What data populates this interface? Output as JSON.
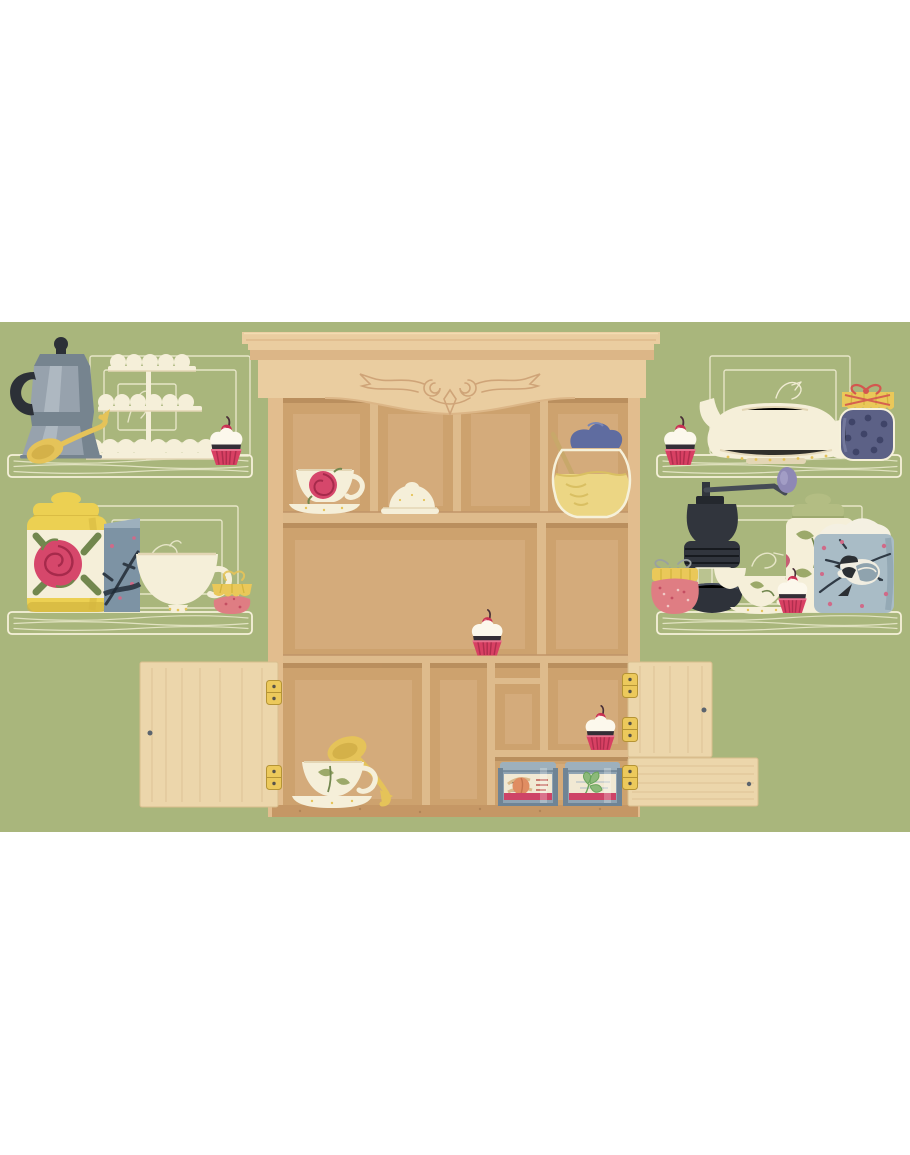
{
  "scene": {
    "title": "Tea cupboard wall illustration",
    "background_color": "#a9b67c",
    "page_background": "#ffffff"
  },
  "palette": {
    "bg_green": "#a9b67c",
    "sketch_cream": "#f6f1da",
    "wood_frame": "#e2bd8e",
    "wood_crown": "#eacda0",
    "wood_crown_shade": "#dcb687",
    "wood_carve": "#cfa478",
    "wood_interior": "#cda26e",
    "wood_interior_light": "#d9b184",
    "wood_divider": "#debb8c",
    "wood_floor": "#c59765",
    "wood_door": "#ecd6ab",
    "wood_door_grain": "#d9bd8f",
    "hinge_gold": "#ecc95b",
    "hinge_dark": "#b59435",
    "knob_grey": "#5b646e",
    "cream": "#f5efd9",
    "cream_shade": "#e3d6b5",
    "gold": "#e5c359",
    "gold_dark": "#c7a23c",
    "pink_wrap": "#d84063",
    "pink_wrap_dark": "#b02e4e",
    "frosting": "#fcf8ec",
    "chocolate": "#342e36",
    "cherry": "#c93052",
    "rose": "#d6476b",
    "rose_dark": "#a62a4b",
    "leaf": "#9ca96a",
    "leaf_dark": "#72874e",
    "ink_black": "#2c3037",
    "moka": "#97a2ad",
    "moka_light": "#aeb8c1",
    "moka_dark": "#76848f",
    "yellow_can": "#ecd052",
    "yellow_can_dark": "#d3b53e",
    "tin_blue": "#7d93a4",
    "tin_blue_light": "#9db0bd",
    "tin_steel": "#8fa3b2",
    "tin_steel_dark": "#6f8495",
    "branch": "#2f3a45",
    "blossom": "#d06a88",
    "jam_red": "#df7d83",
    "jam_red_dark": "#c44e62",
    "lid_yellow": "#eac859",
    "ribbon": "#d4574f",
    "twine": "#9aa0a0",
    "blueberry": "#5c6186",
    "blueberry_dark": "#3f4468",
    "honey": "#ecd684",
    "honey_dark": "#d9bf62",
    "honey_lid": "#5f6ca0",
    "dipper": "#c8a86a",
    "grinder": "#31353d",
    "grinder_dark": "#24282e",
    "knob_purple": "#8e88b5",
    "can_green": "#b3bd83",
    "chick_blue": "#a9bcc6",
    "sugar": "#f4f0e2",
    "bird_black": "#2b2f33",
    "bird_white": "#f0ede1",
    "wing": "#8fa3ae",
    "label_cream": "#f1e9d3",
    "band_pink": "#ce4467",
    "peach": "#e08d62",
    "peach_leaf": "#d9b98a",
    "mint": "#8cb97a",
    "mint_dark": "#69a45b",
    "red_text": "#c05a52",
    "shadow_brown": "#8e643c"
  },
  "items": {
    "cabinet": "Carved wooden wall cabinet",
    "left_shelf_top": "Left upper wall shelf",
    "left_shelf_bottom": "Left lower wall shelf",
    "right_shelf_top": "Right upper wall shelf",
    "right_shelf_bottom": "Right lower wall shelf",
    "moka_pot": "Grey moka espresso pot",
    "gold_spoon": "Gold serving spoon",
    "cake_stand": "Three-tier scalloped dessert stand",
    "cupcake": "Cherry cupcake in pink wrapper",
    "rose_canister": "Yellow canister with rose motif",
    "blossom_tin": "Blue tea tin with blossom branch",
    "white_teacup": "Large cream teacup",
    "cloth_jam_jar": "Red jam jar with yellow cloth lid",
    "teapot": "Cream teapot with bird sketch",
    "blueberry_jar": "Blueberry jam jar with ribbon bow",
    "strawberry_jar": "Strawberry jam jar with twine bow",
    "coffee_grinder": "Black manual coffee grinder",
    "cup_stack": "Cream cups with leaf teacup",
    "leaf_canister": "Leaf-pattern canister with green lid",
    "chickadee_canister": "Blue sugar canister with chickadee",
    "rose_teacup": "Rose teacup on saucer",
    "butter_dish": "Cream butter dish",
    "honey_pot": "Honey pot with wooden dipper",
    "leaf_teacup": "Leaf teacup on saucer",
    "tea_tin_peach": "Peach tea tin",
    "tea_tin_mint": "Mint tea tin",
    "door_left": "Open cabinet door, left",
    "door_right_upper": "Open cabinet door, upper right",
    "door_right_lower": "Open cabinet door, lower right",
    "hinge": "Brass hinge"
  }
}
